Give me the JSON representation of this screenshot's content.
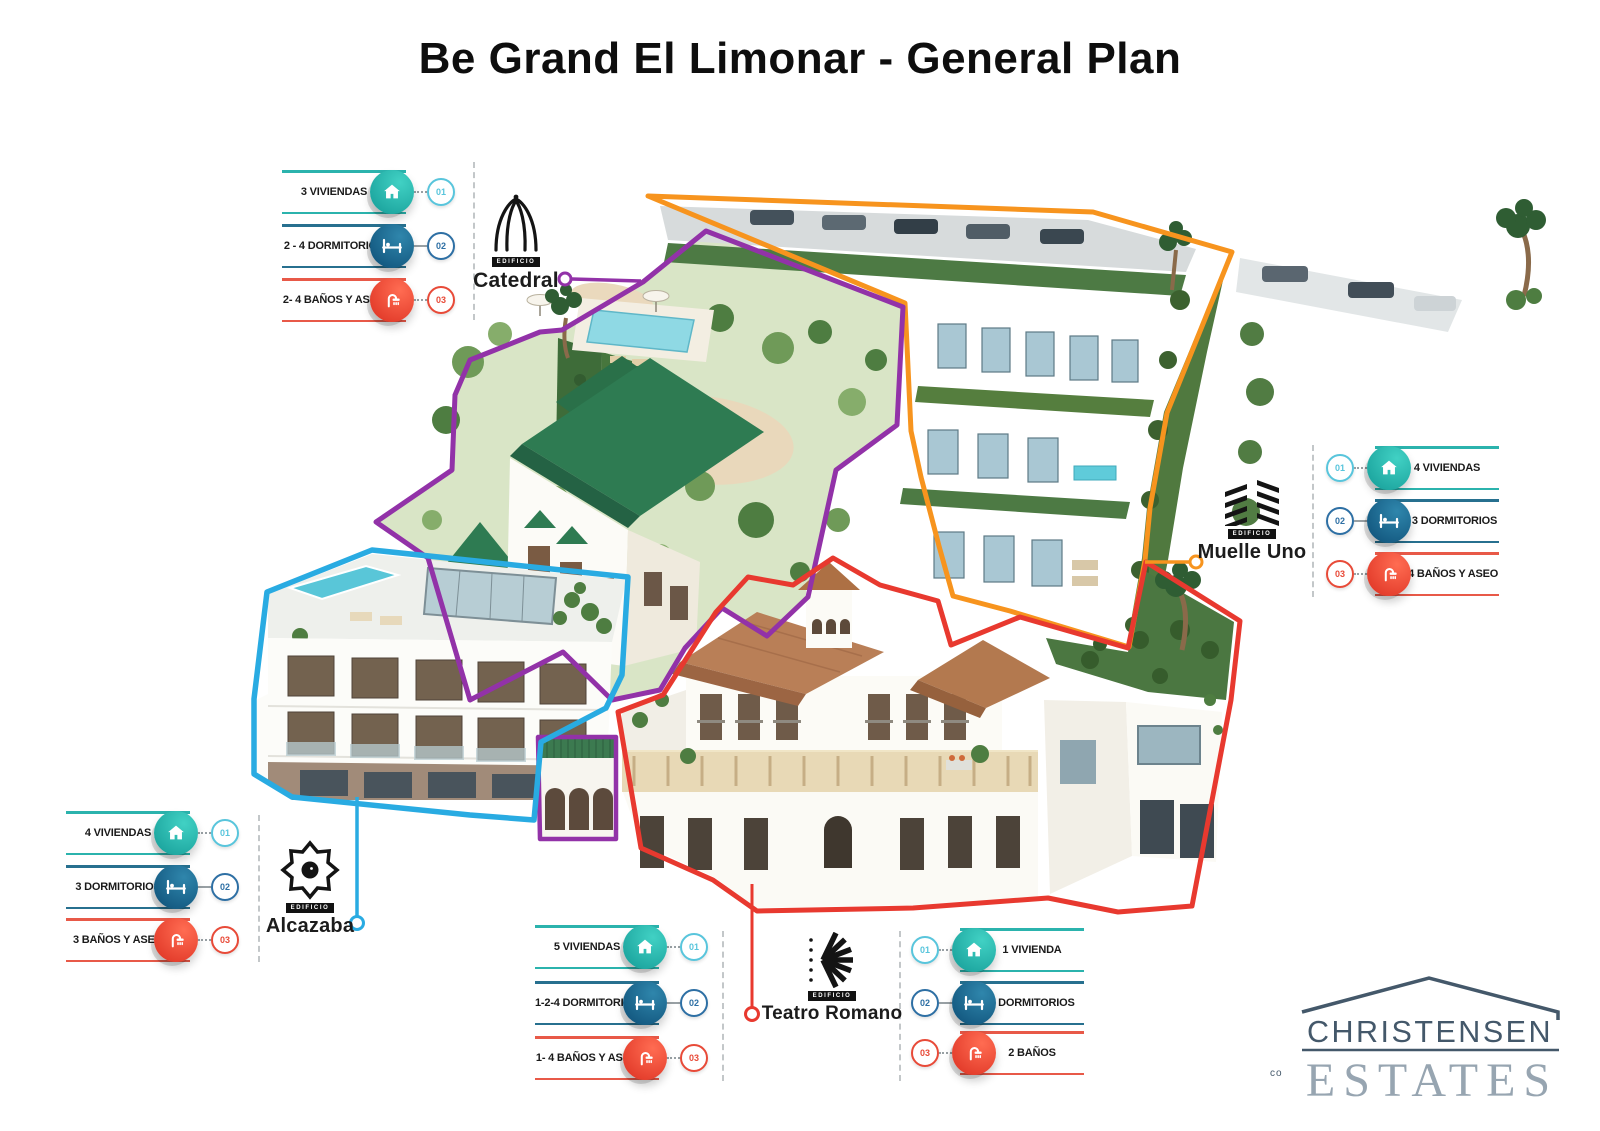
{
  "title": "Be Grand El Limonar - General Plan",
  "palette": {
    "row_viviendas": "#2BB3AD",
    "row_dormitorios": "#27708F",
    "row_banos": "#E85948",
    "zone_catedral": "#9232A8",
    "zone_muelle_uno": "#F7941E",
    "zone_alcazaba": "#29ABE2",
    "zone_teatro_romano": "#E8392F"
  },
  "buildings": {
    "catedral": {
      "name": "Catedral",
      "badge": "EDIFICIO",
      "zone_color": "#9232A8",
      "icon": "cathedral-arches-icon"
    },
    "muelle_uno": {
      "name": "Muelle Uno",
      "badge": "EDIFICIO",
      "zone_color": "#F7941E",
      "icon": "slatted-bars-icon"
    },
    "alcazaba": {
      "name": "Alcazaba",
      "badge": "EDIFICIO",
      "zone_color": "#29ABE2",
      "icon": "eight-pointed-star-icon"
    },
    "teatro_romano": {
      "name": "Teatro Romano",
      "badge": "EDIFICIO",
      "zone_color": "#E8392F",
      "icon": "radial-fan-icon"
    }
  },
  "cards": {
    "catedral": {
      "rows": [
        {
          "num": "01",
          "label": "3 VIVIENDAS",
          "icon": "home-icon"
        },
        {
          "num": "02",
          "label": "2 - 4 DORMITORIOS",
          "icon": "bed-icon"
        },
        {
          "num": "03",
          "label": "2- 4 BAÑOS Y ASEO",
          "icon": "shower-icon"
        }
      ]
    },
    "muelle_uno": {
      "rows": [
        {
          "num": "01",
          "label": "4 VIVIENDAS",
          "icon": "home-icon"
        },
        {
          "num": "02",
          "label": "2 - 3 DORMITORIOS",
          "icon": "bed-icon"
        },
        {
          "num": "03",
          "label": "3- 4 BAÑOS Y ASEO",
          "icon": "shower-icon"
        }
      ]
    },
    "alcazaba": {
      "rows": [
        {
          "num": "01",
          "label": "4 VIVIENDAS",
          "icon": "home-icon"
        },
        {
          "num": "02",
          "label": "3 DORMITORIOS",
          "icon": "bed-icon"
        },
        {
          "num": "03",
          "label": "3 BAÑOS Y ASEO",
          "icon": "shower-icon"
        }
      ]
    },
    "teatro_romano": {
      "rows": [
        {
          "num": "01",
          "label": "5 VIVIENDAS",
          "icon": "home-icon"
        },
        {
          "num": "02",
          "label": "1-2-4 DORMITORIOS",
          "icon": "bed-icon"
        },
        {
          "num": "03",
          "label": "1- 4 BAÑOS Y ASEO",
          "icon": "shower-icon"
        }
      ]
    },
    "unit_b": {
      "rows": [
        {
          "num": "01",
          "label": "1 VIVIENDA",
          "icon": "home-icon"
        },
        {
          "num": "02",
          "label": "2 DORMITORIOS",
          "icon": "bed-icon"
        },
        {
          "num": "03",
          "label": "2 BAÑOS",
          "icon": "shower-icon"
        }
      ]
    }
  },
  "brand": {
    "prefix": "co",
    "name_top": "CHRISTENSEN",
    "name_bottom": "ESTATES"
  }
}
